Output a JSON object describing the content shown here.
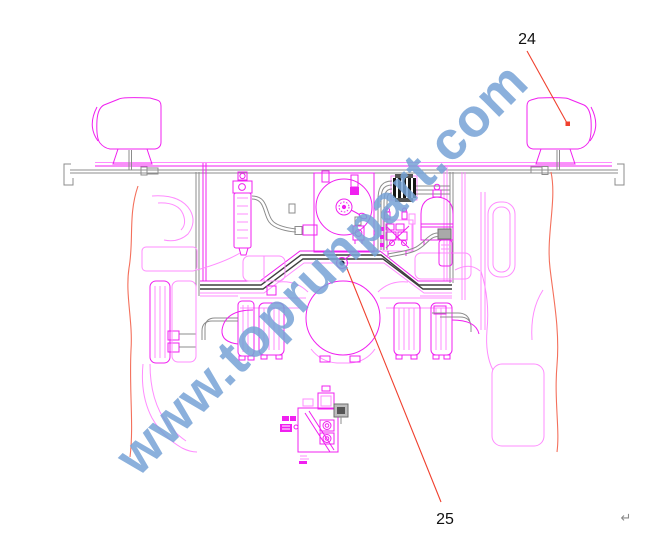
{
  "callouts": {
    "label_24": "24",
    "label_25": "25"
  },
  "watermark": {
    "text": "www.toprunpart.com",
    "color": "#77a3d6"
  },
  "paragraph_mark": "↵",
  "colors": {
    "drawing": "#f020f0",
    "drawing-light": "#ff8cff",
    "pipe-gray": "#8c8c8c",
    "frame-dark": "#3f3f3f",
    "leader-red": "#f0402e",
    "contour-red": "#f4705c",
    "watermark": "#77a3d6",
    "label": "#111111",
    "mark-gray": "#8a8a8a"
  }
}
